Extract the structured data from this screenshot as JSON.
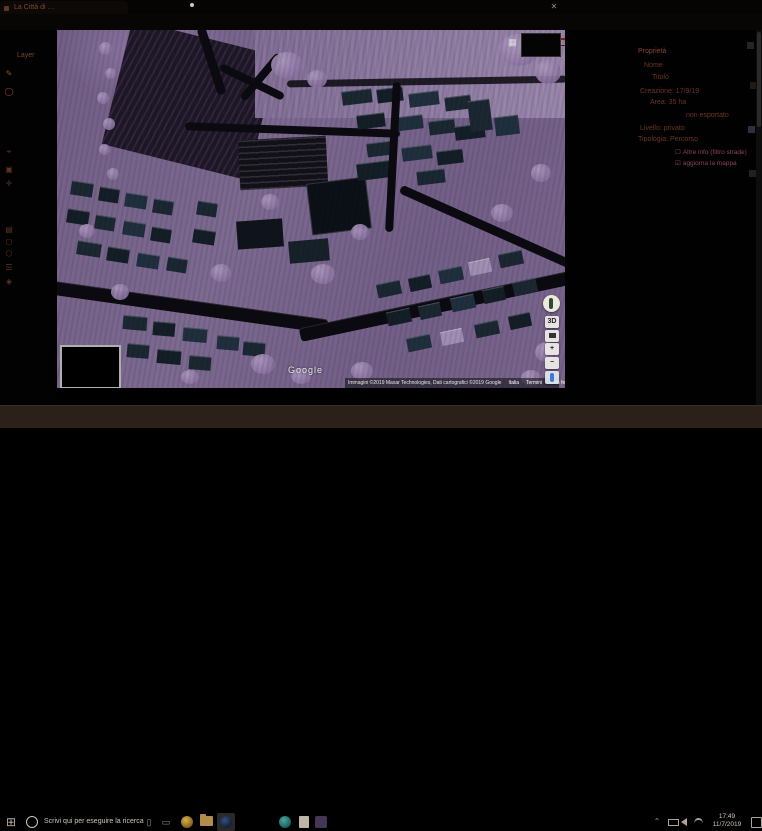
{
  "browser": {
    "tab_title": "La Città di …",
    "panel_close": "✕",
    "back_icon": "←",
    "forward_icon": "→",
    "reload_icon": "↻",
    "logo_letter": "H"
  },
  "sidebar": {
    "layer_label": "Layer",
    "icons": [
      {
        "name": "draw-icon",
        "glyph": "✎"
      },
      {
        "name": "circle-tool-icon",
        "glyph": "◯"
      },
      {
        "name": "marker-icon",
        "glyph": "⌖"
      },
      {
        "name": "area-icon",
        "glyph": "▣"
      },
      {
        "name": "add-icon",
        "glyph": "✛"
      },
      {
        "name": "layers-icon",
        "glyph": "▤"
      },
      {
        "name": "rect-tool-icon",
        "glyph": "◻"
      },
      {
        "name": "polygon-icon",
        "glyph": "⬡"
      },
      {
        "name": "list-icon",
        "glyph": "☰"
      },
      {
        "name": "settings-icon",
        "glyph": "◈"
      }
    ]
  },
  "map": {
    "watermark": "Google",
    "attribution": "Immagini ©2019 Maxar Technologies, Dati cartografici ©2019 Google",
    "links": [
      "Italia",
      "Termini",
      "Invia feedback"
    ],
    "scale_label": "50 m",
    "grid_icon": "▦",
    "controls": {
      "threed": "3D",
      "zoom_in": "+",
      "zoom_out": "−"
    }
  },
  "panel": {
    "rows": [
      {
        "text": "Proprietà"
      },
      {
        "text": "Nome"
      },
      {
        "text": "Titolo"
      },
      {
        "text": "Creazione:  17/9/19"
      },
      {
        "text": "Area:  35 ha"
      },
      {
        "text": "non esportato"
      },
      {
        "text": "Livello:  privato"
      },
      {
        "text": "Tipologia:  Percorso"
      }
    ],
    "checkboxes": [
      {
        "box": "☐",
        "label": "Altre info (filtro strade)"
      },
      {
        "box": "☑",
        "label": "aggiorna la mappa"
      }
    ]
  },
  "taskbar": {
    "start_glyph": "⊞",
    "search_text": "Scrivi qui per eseguire la ricerca",
    "tray_chevron": "⌃",
    "clock_time": "17:49",
    "clock_date": "11/7/2019"
  }
}
